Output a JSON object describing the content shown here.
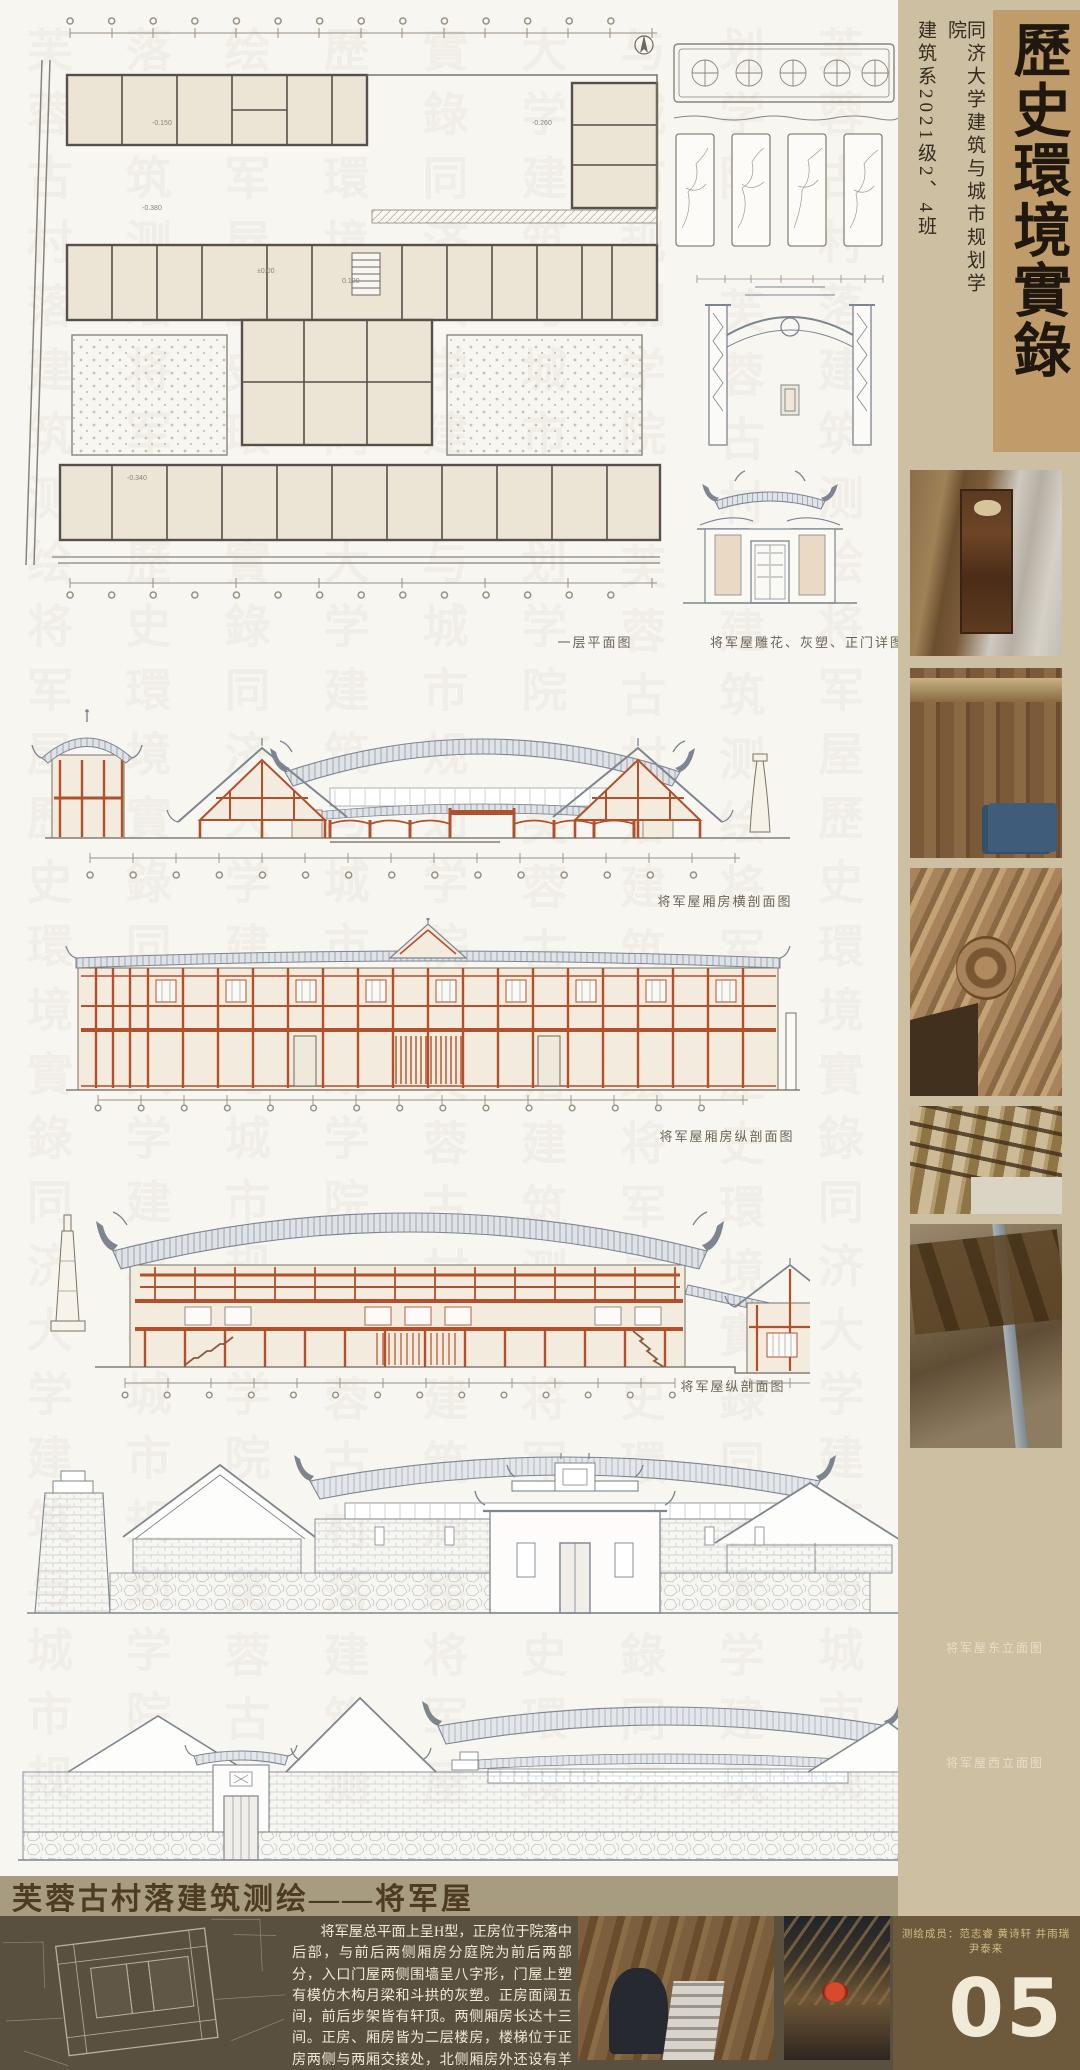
{
  "board": {
    "width": 1080,
    "height": 2070
  },
  "masthead": {
    "title": "歷史環境實錄",
    "school": "同济大学建筑与城市规划学院",
    "class_line": "建筑系2021级2、4班"
  },
  "drawings": {
    "plan_caption": "一层平面图",
    "plan_levels": [
      "-0.150",
      "-0.380",
      "±0.00",
      "0.100",
      "-0.260",
      "-0.340"
    ],
    "detail_caption": "将军屋雕花、灰塑、正门详图",
    "section_cross_caption": "将军屋厢房横剖面图",
    "section_wing_long_caption": "将军屋厢房纵剖面图",
    "section_long_caption": "将军屋纵剖面图",
    "east_elevation_caption": "将军屋东立面图",
    "west_elevation_caption": "将军屋西立面图"
  },
  "sidebar_photos": [
    {
      "name": "carved-wood-shrine-photo"
    },
    {
      "name": "timber-wall-lattice-photo"
    },
    {
      "name": "carved-beam-detail-photo"
    },
    {
      "name": "roof-truss-photo"
    },
    {
      "name": "beams-and-pipes-photo"
    }
  ],
  "footer": {
    "banner_title": "芙蓉古村落建筑测绘——将军屋",
    "description": "将军屋总平面上呈H型，正房位于院落中后部，与前后两侧厢房分庭院为前后两部分，入口门屋两侧围墙呈八字形，门屋上塑有模仿木构月梁和斗拱的灰塑。正房面阔五间，前后步架皆有轩顶。两侧厢房长达十三间。正房、厢房皆为二层楼房，楼梯位于正房两侧与两厢交接处，北侧厢房外还设有羊圈和鸡房。",
    "credits": "测绘成员：范志睿 黄诗轩 井雨瑞 尹泰来",
    "page_number": "05",
    "photos": [
      {
        "name": "surveyor-on-ladder-photo"
      },
      {
        "name": "roof-corner-lantern-photo"
      }
    ]
  },
  "colors": {
    "sidebar_beige": "#cdbfa2",
    "title_box_tan": "#bf9c6a",
    "banner_khaki": "#a89c80",
    "footer_dark": "#59503f",
    "footer_brown": "#6d5a3c",
    "timber_red": "#b2502b",
    "roof_gray": "#7d8590",
    "wall_cream": "#f3ebdd",
    "credit_gold": "#d3bd85",
    "page_cream": "#f1ead7"
  },
  "watermark_text": "芙蓉古村落建筑测绘将军屋歷史環境實錄同济大学建筑与城市规划学院"
}
